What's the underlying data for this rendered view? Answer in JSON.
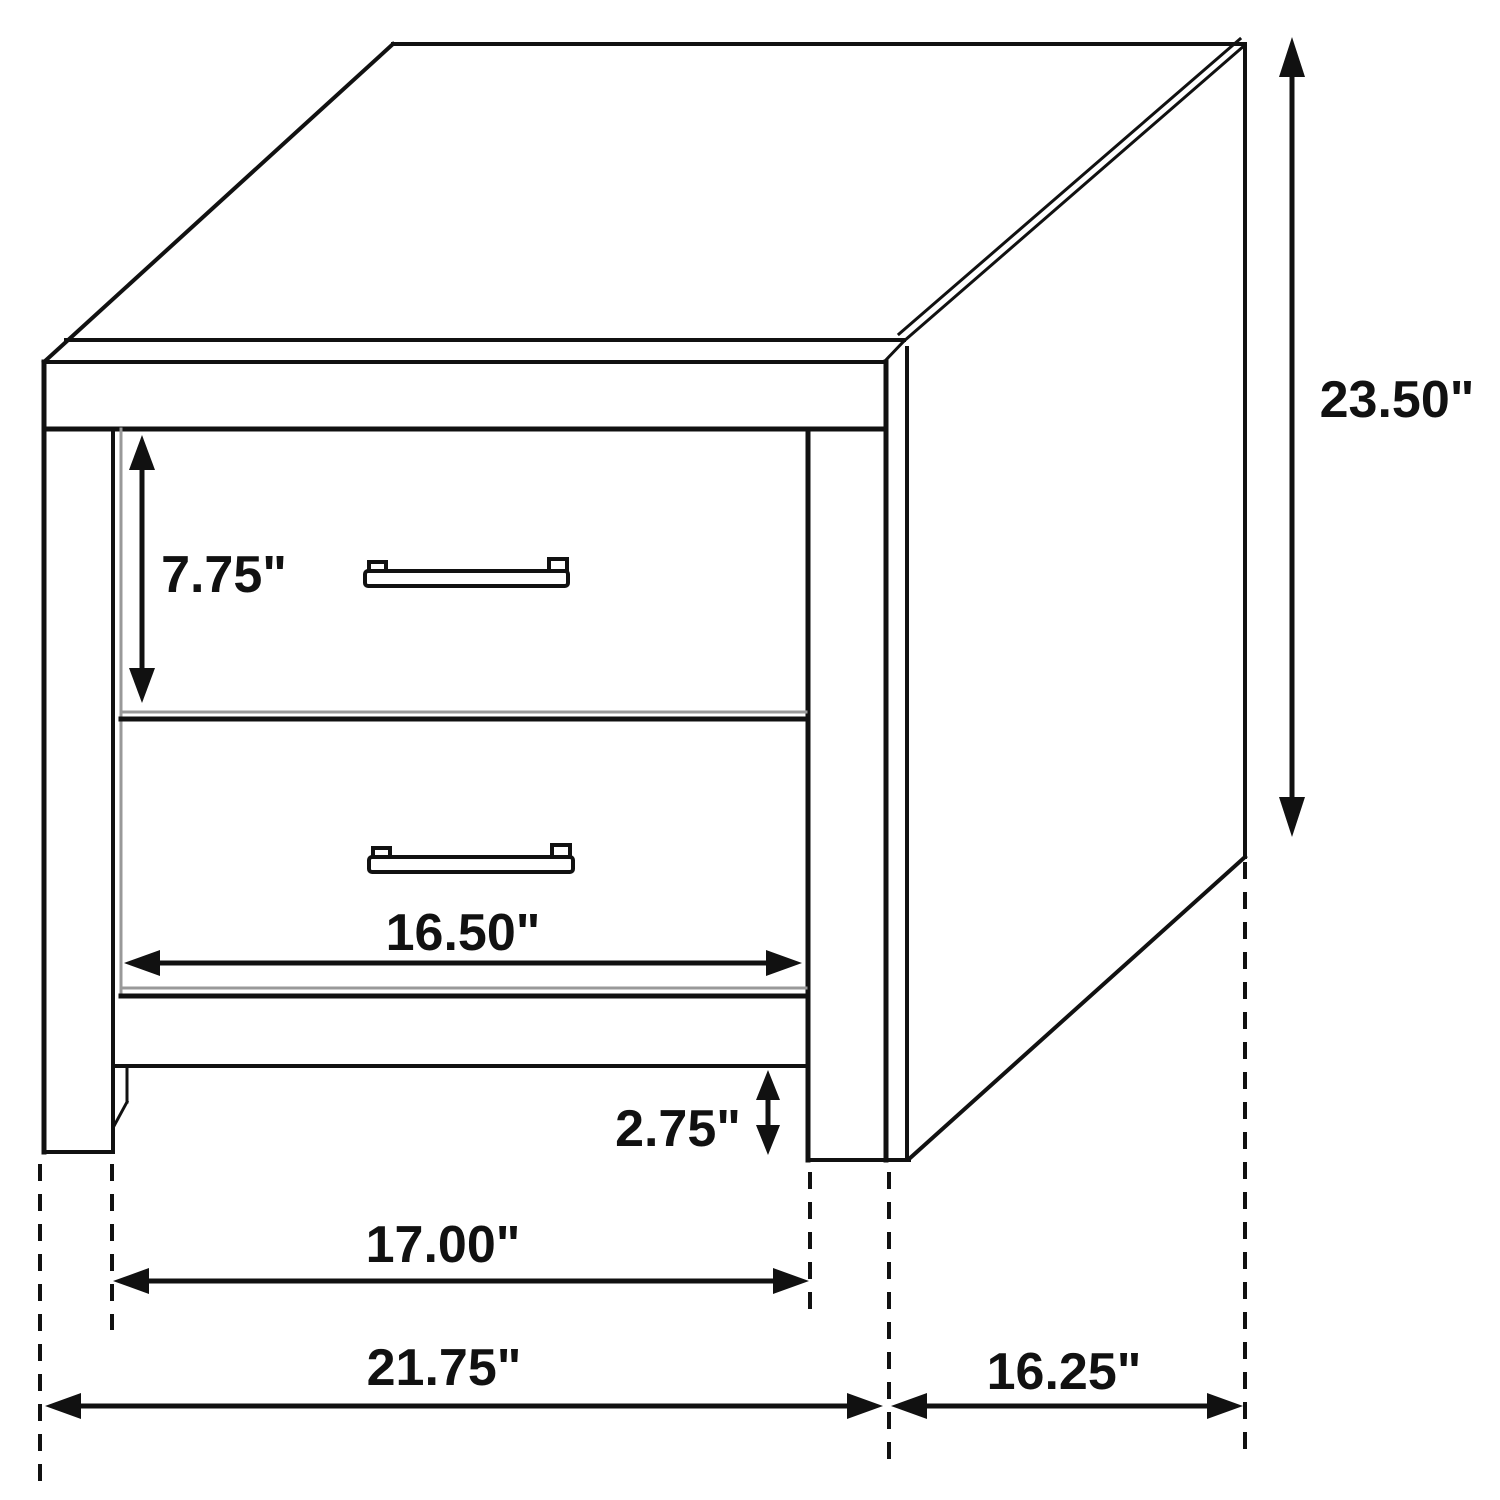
{
  "figure": {
    "description": "Line drawing of a two-drawer nightstand with dimension arrows",
    "unit": "inches"
  },
  "dimensions": {
    "overall_height": "23.50\"",
    "drawer_front_height": "7.75\"",
    "drawer_width": "16.50\"",
    "leg_clearance": "2.75\"",
    "inner_width": "17.00\"",
    "overall_width": "21.75\"",
    "depth": "16.25\""
  },
  "colors": {
    "line": "#111111",
    "shade": "#999999",
    "background": "#ffffff"
  }
}
